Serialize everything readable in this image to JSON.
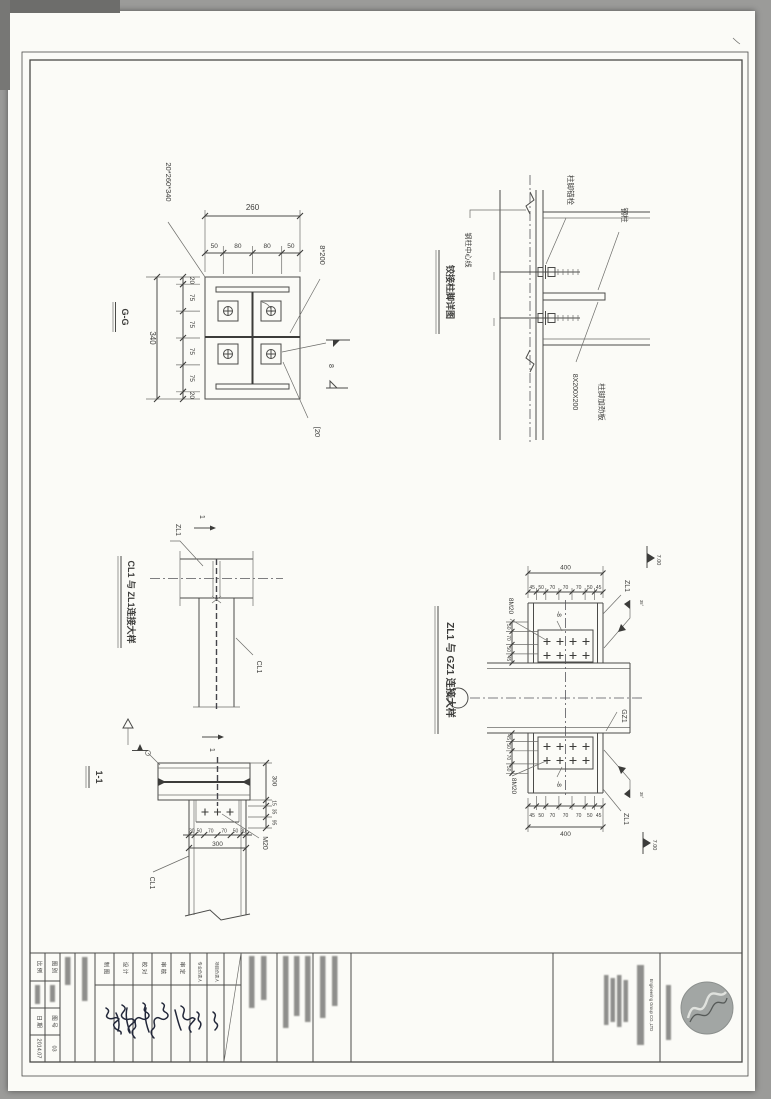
{
  "colors": {
    "paper": "#fbfbf7",
    "line": "#4b4b49",
    "accent_ink": "#23283a",
    "logo_fill": "#a2a6a4"
  },
  "details": {
    "base_plate": {
      "section_label": "G-G",
      "plate_callout": "20*260*340",
      "stiffener_callout": "8*200",
      "weld_size": "8",
      "channel_callout": "[20",
      "dim_total_width": "260",
      "dims_width": [
        "50",
        "80",
        "80",
        "50"
      ],
      "dim_total_height": "340",
      "dims_height": [
        "20",
        "75",
        "75",
        "75",
        "75",
        "20"
      ]
    },
    "column_base": {
      "title": "铰接柱脚详图",
      "centerline_label": "钢柱中心线",
      "anchor_bolt_label": "柱脚锚栓",
      "steel_column_label": "钢柱",
      "stiffener_size": "8X200X200",
      "stiffener_label": "柱脚加劲板"
    },
    "cl1_zl1": {
      "title": "CL1 与 ZL1连接大样",
      "beam_top_label": "ZL1",
      "beam_bottom_label": "CL1",
      "section_mark": "1"
    },
    "section_1_1": {
      "title": "1-1",
      "bolt_callout": "M20",
      "column_label": "CL1",
      "dim_total": "300",
      "dims": [
        "30",
        "50",
        "70",
        "70",
        "50",
        "30"
      ],
      "right_dims": [
        "300",
        "15",
        "35",
        "95"
      ]
    },
    "zl1_gz1": {
      "title": "ZL1 与 GZ1 连接大样",
      "beam_label": "ZL1",
      "column_label": "GZ1",
      "bolt_group_callout": "8M20",
      "plate_callout": "-8",
      "dim_total": "400",
      "dims": [
        "45",
        "50",
        "70",
        "70",
        "70",
        "50",
        "45"
      ],
      "side_dims_top": [
        "50",
        "70",
        "50",
        "45"
      ],
      "side_dims_bottom": [
        "45",
        "50",
        "70",
        "50"
      ],
      "weld_note": "35°",
      "level_top": "7.00",
      "level_bottom": "7.00"
    }
  },
  "title_block": {
    "scale_label": "比 例",
    "category_label": "图 别",
    "number_label": "图 号",
    "date_label": "日 期",
    "date_value": "2014.07",
    "number_value": "03",
    "sign_labels": [
      "制 图",
      "设 计",
      "校 对",
      "审 核",
      "审 定"
    ],
    "lead_label_1": "专业负责人",
    "lead_label_2": "项目负责人",
    "company_english": "Engineering Group CO.,LTD"
  }
}
